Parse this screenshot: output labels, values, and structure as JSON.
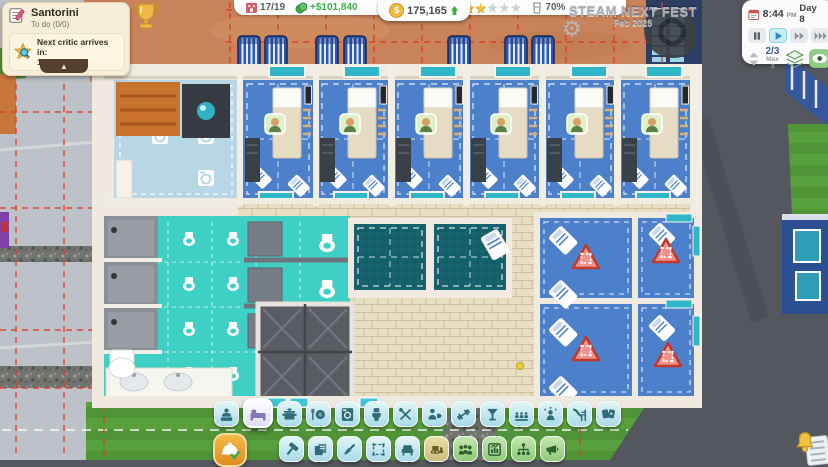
{
  "objectives": {
    "title": "Santorini",
    "todo": "To do (0/0)",
    "notice_line1": "Next critic arrives in:",
    "notice_line2": "1 day",
    "collapse_glyph": "▲"
  },
  "hud": {
    "rooms": "17/19",
    "income": "+$101,840",
    "money": "175,165",
    "currency_symbol": "$",
    "stars_filled": 2,
    "stars_total": 5,
    "satisfaction": "70%"
  },
  "watermark": {
    "title": "STEAM NEXT FEST",
    "subtitle": "Feb 2025"
  },
  "clock": {
    "time": "8:44",
    "meridiem": "PM",
    "day": "Day 8",
    "floor": "2/3",
    "floor_max": "Max 3",
    "speeds": [
      {
        "id": "pause",
        "active": false
      },
      {
        "id": "play",
        "active": true
      },
      {
        "id": "fast-forward",
        "active": false
      },
      {
        "id": "fastest-forward",
        "active": false
      }
    ]
  },
  "room_tools": [
    {
      "id": "reception",
      "selected": false
    },
    {
      "id": "bedroom",
      "selected": true
    },
    {
      "id": "kitchen",
      "selected": false
    },
    {
      "id": "restaurant",
      "selected": false
    },
    {
      "id": "laundry",
      "selected": false
    },
    {
      "id": "toilets",
      "selected": false
    },
    {
      "id": "workshop",
      "selected": false
    },
    {
      "id": "staff-room",
      "selected": false
    },
    {
      "id": "gym",
      "selected": false
    },
    {
      "id": "bar",
      "selected": false
    },
    {
      "id": "cinema",
      "selected": false
    },
    {
      "id": "entertainment",
      "selected": false
    },
    {
      "id": "pool",
      "selected": false
    },
    {
      "id": "casino",
      "selected": false
    }
  ],
  "build_tools": [
    {
      "id": "confirm-build",
      "style": "orange"
    },
    {
      "id": "hammer",
      "style": "cyan"
    },
    {
      "id": "blueprints",
      "style": "cyan"
    },
    {
      "id": "paint",
      "style": "cyan"
    },
    {
      "id": "zone-select",
      "style": "cyan"
    },
    {
      "id": "furniture",
      "style": "cyan"
    },
    {
      "id": "demolish",
      "style": "tan"
    },
    {
      "id": "staff",
      "style": "green"
    },
    {
      "id": "finances",
      "style": "green"
    },
    {
      "id": "management",
      "style": "green"
    },
    {
      "id": "marketing",
      "style": "green"
    }
  ],
  "colors": {
    "grid_red": "#e23a26",
    "money_gold": "#f0b93c",
    "income_green": "#3fae4a",
    "star_gold": "#f2c13c",
    "bathroom_teal": "#3ed0c4",
    "bedroom_blue": "#4d80cb",
    "terracotta": "#c9835a"
  }
}
